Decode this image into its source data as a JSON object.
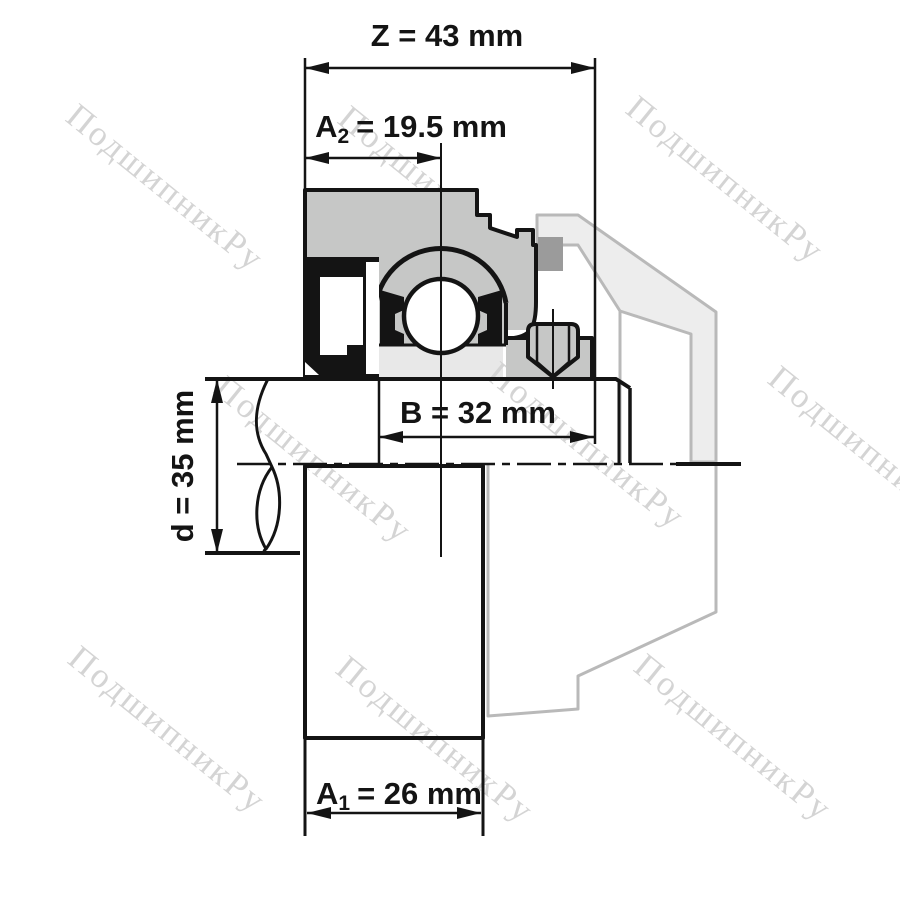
{
  "watermark": {
    "text": "ПодшипникРу",
    "color": "#d4d4d4",
    "count": 9
  },
  "dimensions": {
    "Z": {
      "full": "Z = 43 mm",
      "symbol": "Z",
      "subscript": "",
      "tail": "= 43 mm",
      "value_mm": 43
    },
    "A2": {
      "full": "A2 = 19.5 mm",
      "symbol": "A",
      "subscript": "2",
      "tail": "= 19.5 mm",
      "value_mm": 19.5
    },
    "B": {
      "full": "B = 32 mm",
      "symbol": "B",
      "subscript": "",
      "tail": "= 32 mm",
      "value_mm": 32
    },
    "d": {
      "full": "d = 35 mm",
      "symbol": "d",
      "subscript": "",
      "tail": "= 35 mm",
      "value_mm": 35
    },
    "A1": {
      "full": "A1 = 26 mm",
      "symbol": "A",
      "subscript": "1",
      "tail": "= 26 mm",
      "value_mm": 26
    }
  },
  "colors": {
    "line": "#141414",
    "housing_fill": "#c6c7c6",
    "inner_light": "#e8e8e8",
    "seal_black": "#141414",
    "ghost_fill": "#ededed",
    "ghost_stroke": "#b9b9b9",
    "ghost_dark": "#9b9b9b",
    "watermark": "#d4d4d4",
    "background": "#ffffff"
  }
}
